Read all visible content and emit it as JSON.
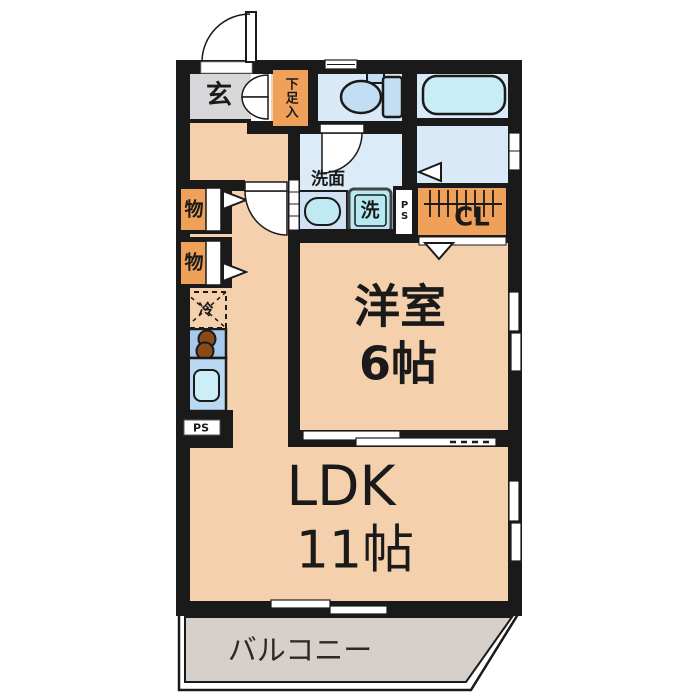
{
  "title": "apartment-floorplan",
  "rooms": {
    "genkan": {
      "label": "玄"
    },
    "shoe": {
      "label": "下足入"
    },
    "washroom": {
      "label": "洗面"
    },
    "washer": {
      "label": "洗"
    },
    "ps_upper": {
      "label": "PS"
    },
    "closet": {
      "label": "CL"
    },
    "storage1": {
      "label": "物"
    },
    "storage2": {
      "label": "物"
    },
    "fridge": {
      "label": "冷"
    },
    "ps_kitchen": {
      "label": "PS"
    },
    "western": {
      "label": "洋室",
      "size": "6帖"
    },
    "ldk": {
      "label": "LDK",
      "size": "11帖"
    },
    "balcony": {
      "label": "バルコニー"
    }
  },
  "colors": {
    "wall": "#1a1a1a",
    "floor_peach": "#f4d0ad",
    "genkan_gray": "#d7d7d9",
    "storage_orange": "#f0a159",
    "wet_room_blue": "#d9e9f7",
    "fixture_cyan": "#bce9f4",
    "kitchen_blue": "#a6c8ea",
    "sink_blue": "#bad8f1",
    "balcony_gray": "#d7cfc9",
    "burner_brown": "#8a4a1a"
  }
}
